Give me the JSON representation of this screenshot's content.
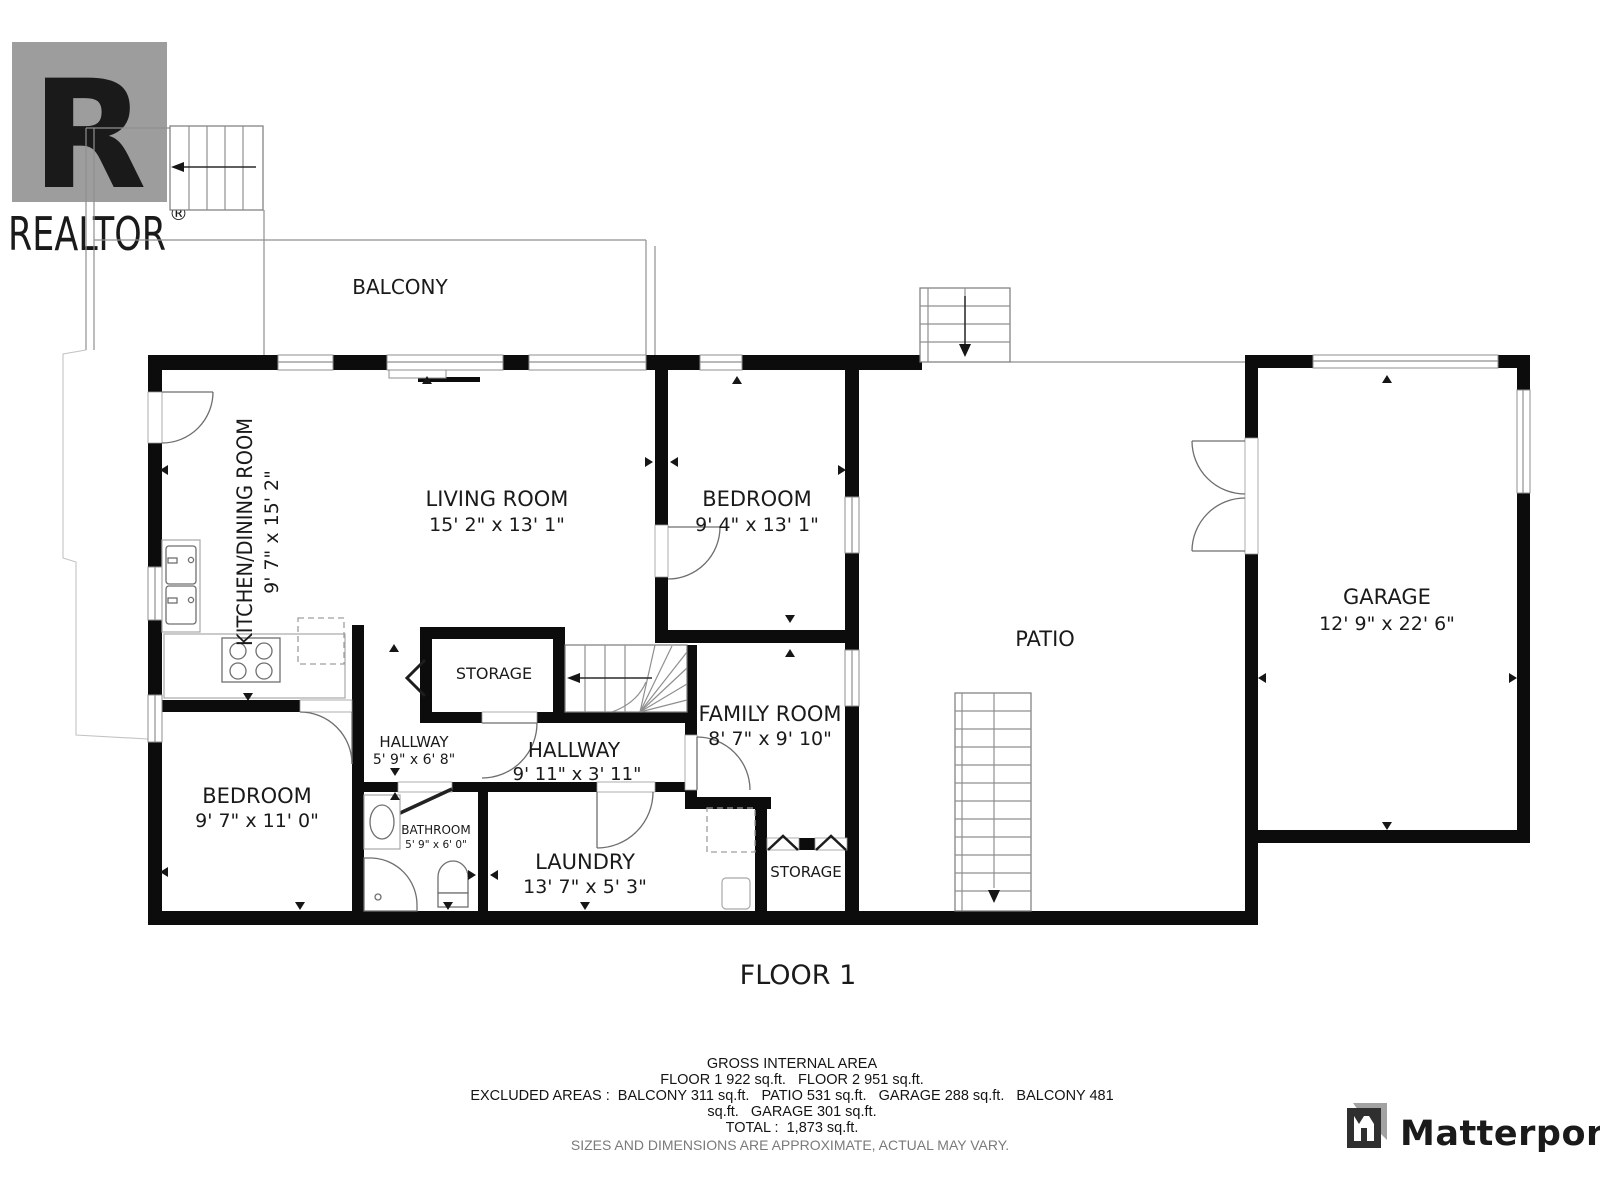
{
  "page": {
    "background": "#ffffff"
  },
  "branding": {
    "realtor": {
      "letter": "R",
      "wordmark": "REALTOR",
      "registered": "®",
      "color": "#a9a9a9"
    },
    "matterport": {
      "wordmark": "Matterport",
      "color": "#3a3a3a"
    }
  },
  "floor": {
    "title": "FLOOR 1"
  },
  "rooms": {
    "balcony": {
      "name": "BALCONY"
    },
    "kitchen_dining": {
      "name": "KITCHEN/DINING ROOM",
      "dims": "9' 7\" x 15' 2\""
    },
    "living_room": {
      "name": "LIVING ROOM",
      "dims": "15' 2\" x 13' 1\""
    },
    "bedroom_upper": {
      "name": "BEDROOM",
      "dims": "9' 4\" x 13' 1\""
    },
    "patio": {
      "name": "PATIO"
    },
    "garage": {
      "name": "GARAGE",
      "dims": "12' 9\" x 22' 6\""
    },
    "storage_mid": {
      "name": "STORAGE"
    },
    "hallway_small": {
      "name": "HALLWAY",
      "dims": "5' 9\" x 6' 8\""
    },
    "hallway_main": {
      "name": "HALLWAY",
      "dims": "9' 11\" x 3' 11\""
    },
    "family_room": {
      "name": "FAMILY ROOM",
      "dims": "8' 7\" x 9' 10\""
    },
    "bedroom_lower": {
      "name": "BEDROOM",
      "dims": "9' 7\" x 11' 0\""
    },
    "bathroom": {
      "name": "BATHROOM",
      "dims": "5' 9\" x 6' 0\""
    },
    "laundry": {
      "name": "LAUNDRY",
      "dims": "13' 7\" x 5' 3\""
    },
    "storage_lower": {
      "name": "STORAGE"
    }
  },
  "footer": {
    "title": "GROSS INTERNAL AREA",
    "line_floors": "FLOOR 1 922 sq.ft.   FLOOR 2 951 sq.ft.",
    "line_excluded_1": "EXCLUDED AREAS :  BALCONY 311 sq.ft.   PATIO 531 sq.ft.   GARAGE 288 sq.ft.   BALCONY 481",
    "line_excluded_2": "sq.ft.   GARAGE 301 sq.ft.",
    "line_total": "TOTAL :  1,873 sq.ft.",
    "disclaimer": "SIZES AND DIMENSIONS ARE APPROXIMATE, ACTUAL MAY VARY."
  }
}
